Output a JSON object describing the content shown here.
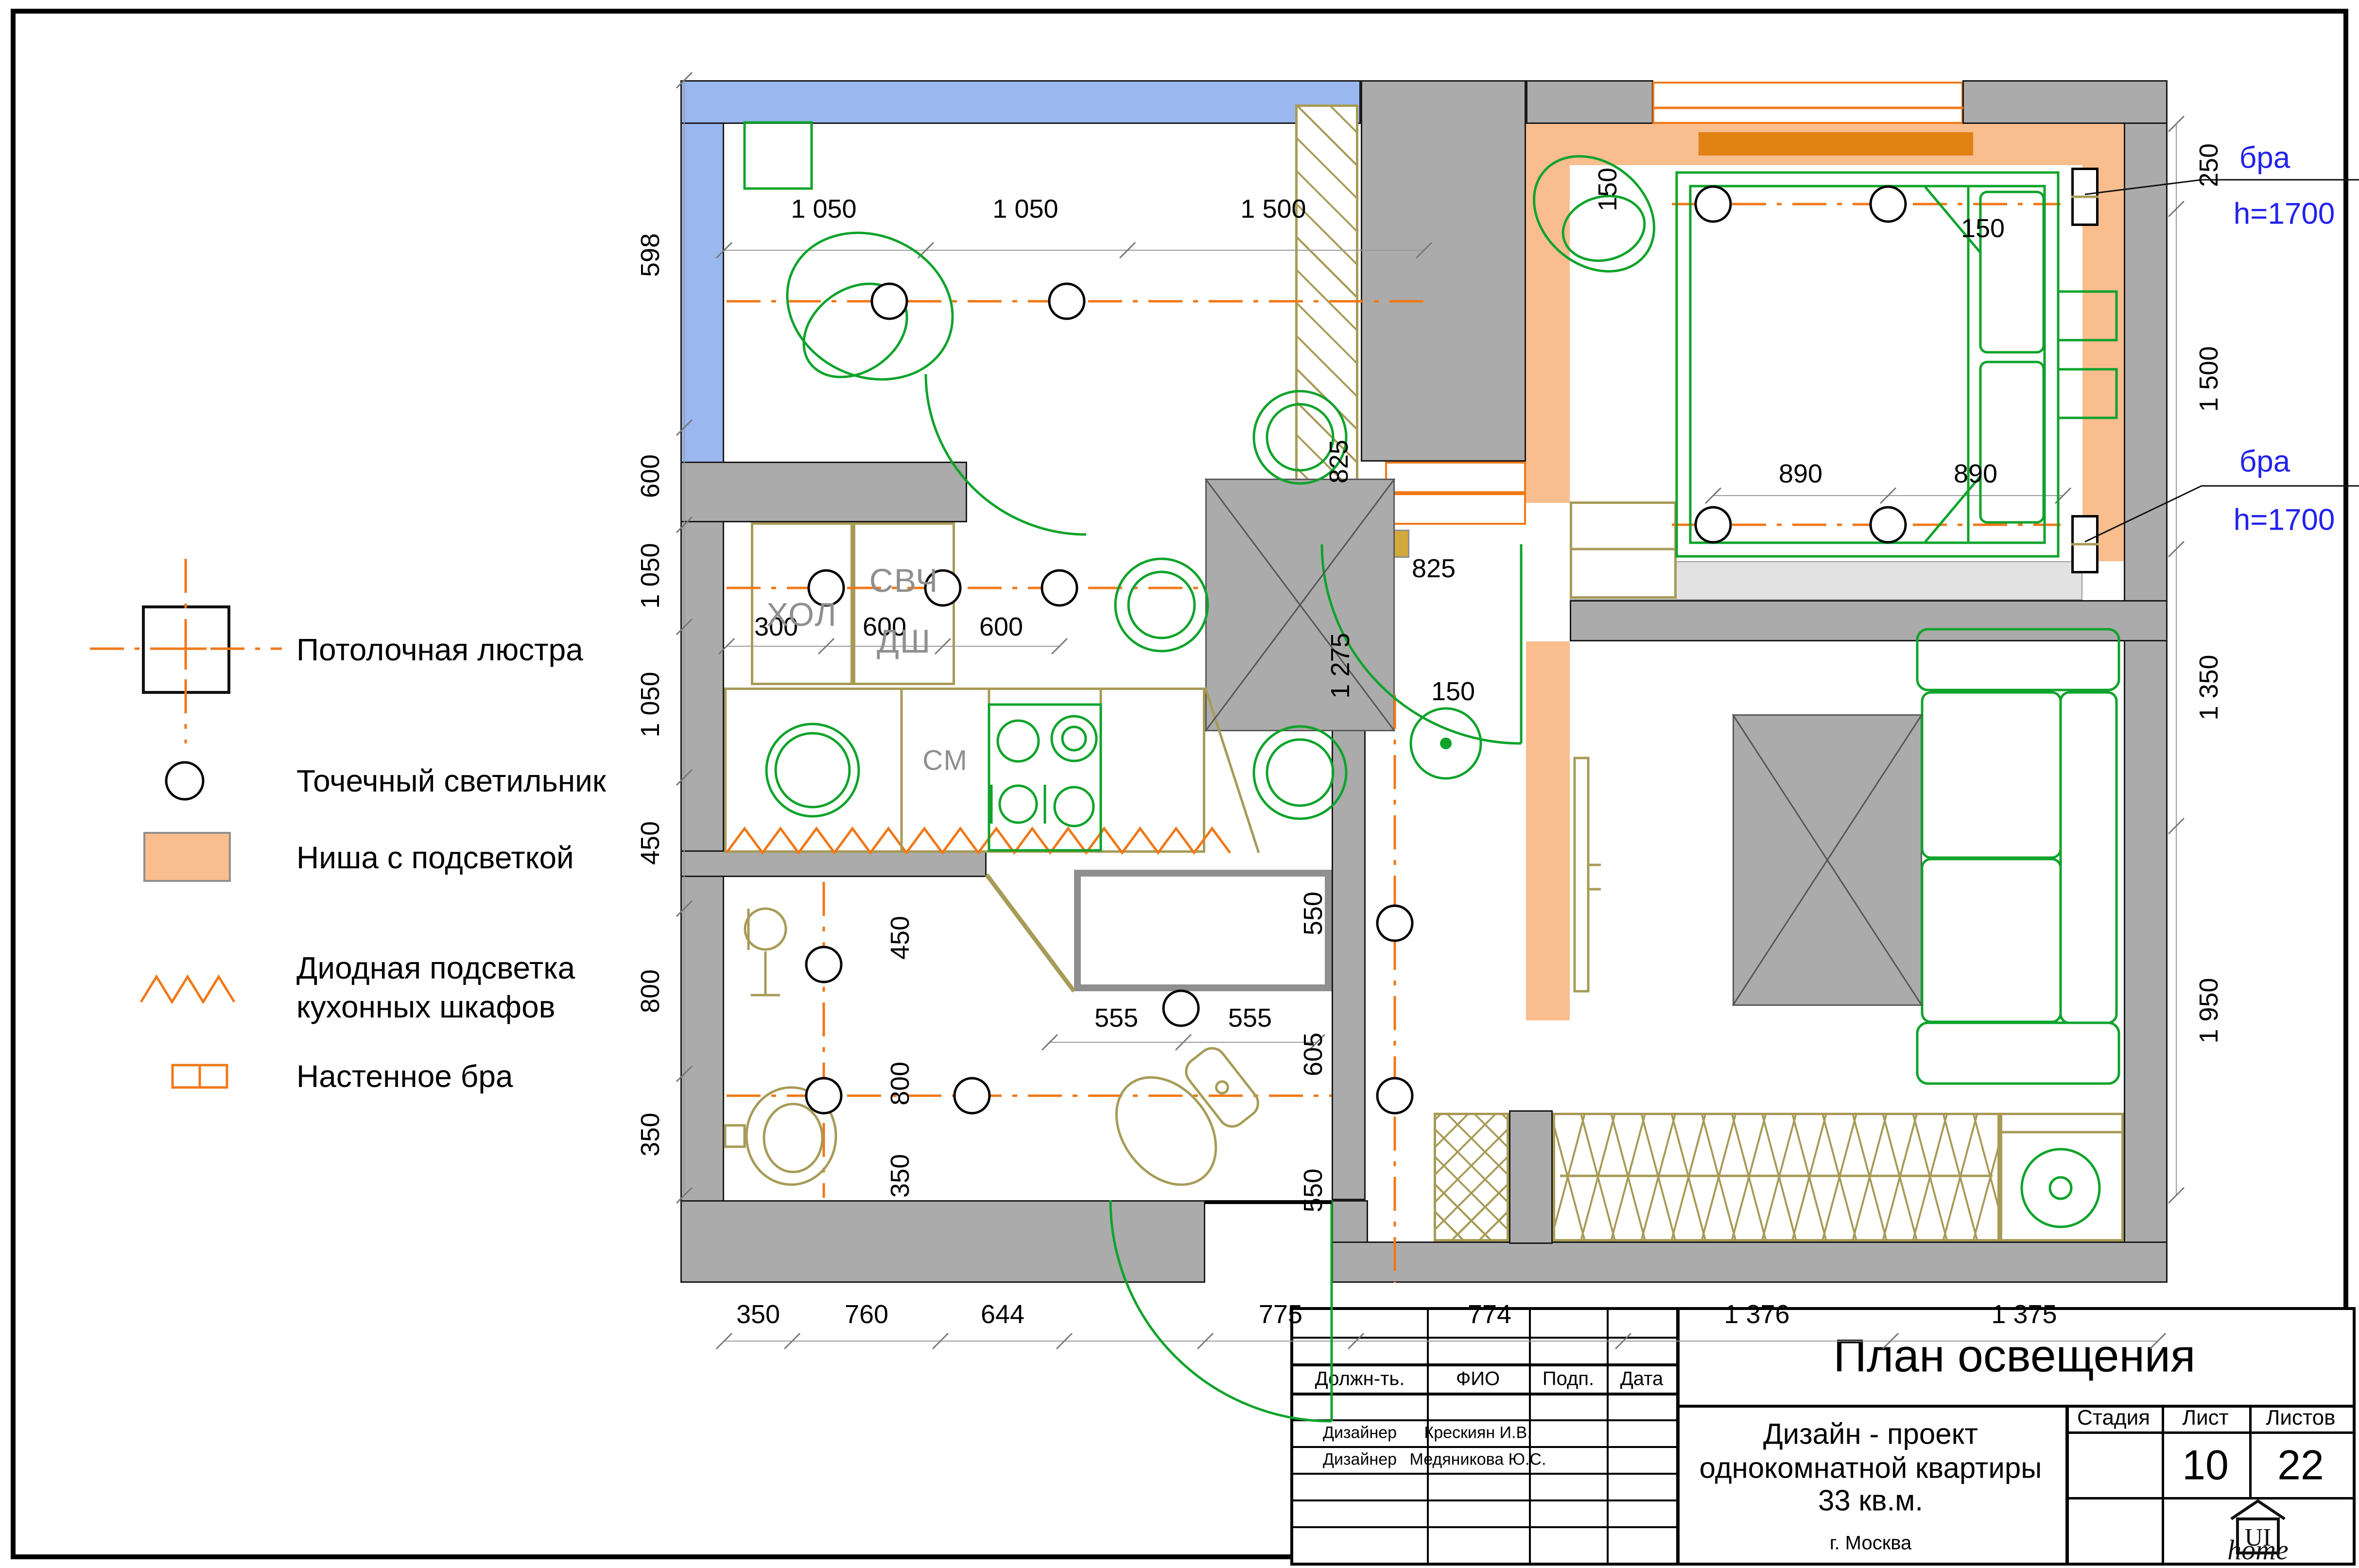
{
  "legend": {
    "items": [
      {
        "label": "Потолочная люстра"
      },
      {
        "label": "Точечный светильник"
      },
      {
        "label": "Ниша с подсветкой"
      },
      {
        "label_line1": "Диодная подсветка",
        "label_line2": "кухонных шкафов"
      },
      {
        "label": "Настенное бра"
      }
    ]
  },
  "plan": {
    "rooms": {
      "fridge": "ХОЛ",
      "microwave": "СВЧ",
      "dishwasher": "ДШ",
      "washer_label": "СМ"
    },
    "sconces": {
      "top": {
        "name": "бра",
        "height": "h=1700"
      },
      "bottom": {
        "name": "бра",
        "height": "h=1700"
      }
    },
    "dims": {
      "top": [
        "1 050",
        "1 050",
        "1 500"
      ],
      "left": [
        "598",
        "600",
        "1 050",
        "1 050",
        "450",
        "800",
        "350"
      ],
      "right": [
        "250",
        "1 500",
        "1 350",
        "1 950"
      ],
      "bottom": [
        "350",
        "760",
        "644",
        "775",
        "774",
        "1 376",
        "1 375"
      ],
      "kitchen_row": [
        "300",
        "600",
        "600"
      ],
      "bedroom": [
        "150",
        "150",
        "890",
        "890"
      ],
      "living": [
        "825",
        "825",
        "1 275",
        "150"
      ],
      "hall": [
        "550",
        "605",
        "550"
      ],
      "bath": [
        "450",
        "800",
        "350",
        "555",
        "555"
      ]
    }
  },
  "titleblock": {
    "title": "План освещения",
    "sig_headers": [
      "Должн-ть.",
      "ФИО",
      "Подп.",
      "Дата"
    ],
    "sig_rows": [
      {
        "role": "Дизайнер",
        "name": "Крескиян И.В."
      },
      {
        "role": "Дизайнер",
        "name": "Медяникова Ю.С."
      }
    ],
    "project_line1": "Дизайн - проект",
    "project_line2": "однокомнатной квартиры",
    "project_line3": "33 кв.м.",
    "city": "г. Москва",
    "meta_headers": [
      "Стадия",
      "Лист",
      "Листов"
    ],
    "sheet_number": "10",
    "sheets_total": "22",
    "logo_text": "UI",
    "logo_script": "home"
  },
  "colors": {
    "wall": "#ababab",
    "balcony_glass": "#9ab7f0",
    "niche": "#f9bd8e",
    "accent_orange": "#f07818",
    "accent_dark": "#e08214",
    "furniture_green": "#0ea32b",
    "line_tan": "#a79b57",
    "annotation_blue": "#2222ee",
    "sill": "#e2e2e2",
    "shelf": "#d2a93d"
  }
}
